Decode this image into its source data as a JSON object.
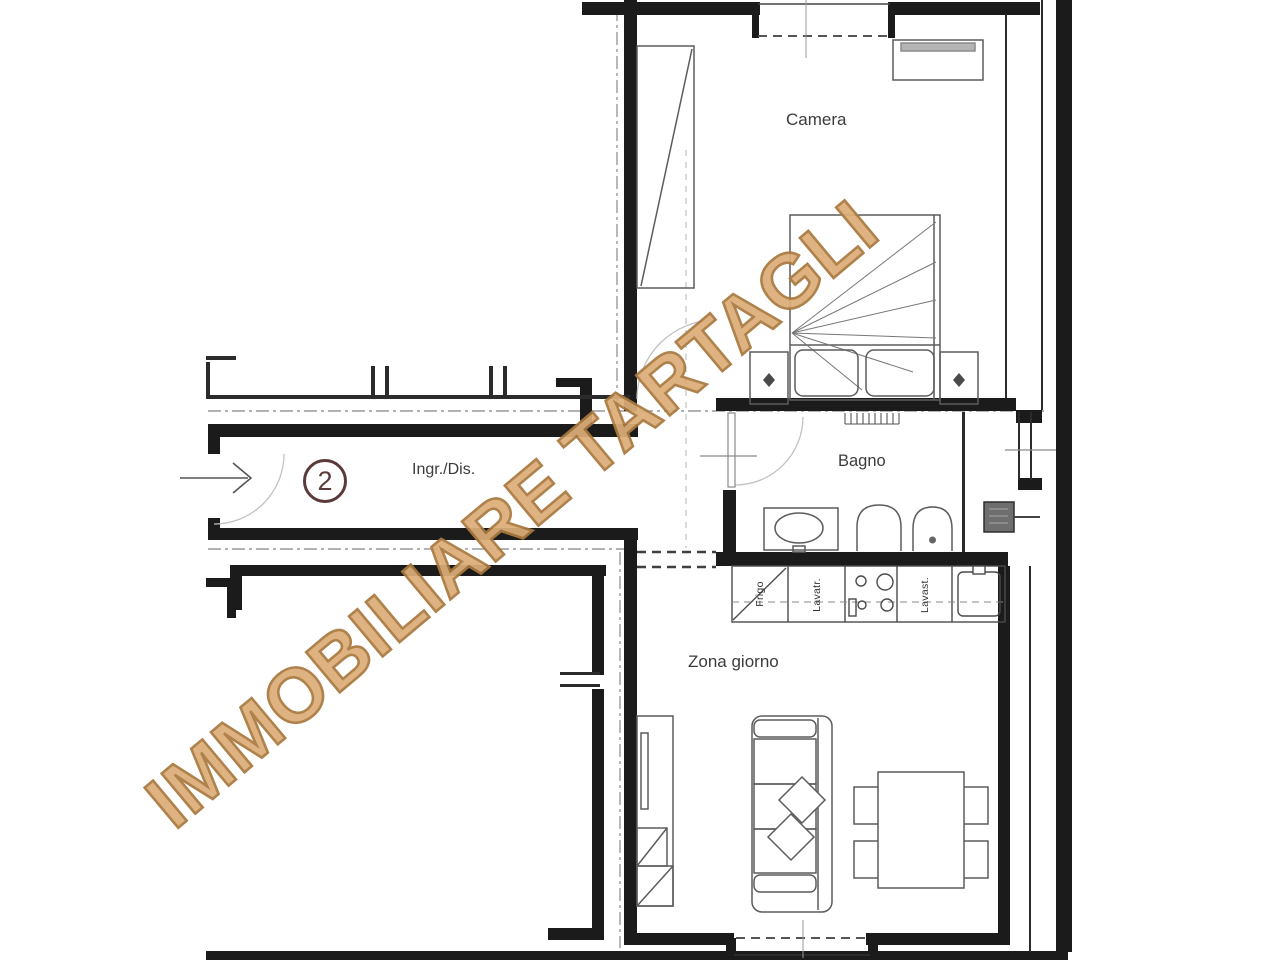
{
  "watermark": {
    "text": "IMMOBILIARE TARTAGLI",
    "color": "#d8a96b"
  },
  "unit": {
    "number": "2",
    "badge_color": "#5a3a3a"
  },
  "rooms": {
    "bedroom": {
      "label": "Camera"
    },
    "bathroom": {
      "label": "Bagno"
    },
    "hall": {
      "label": "Ingr./Dis."
    },
    "living": {
      "label": "Zona giorno"
    }
  },
  "kitchen": {
    "appliances": [
      {
        "label": "Frigo"
      },
      {
        "label": "Lavatr."
      },
      {
        "label": "Lavast."
      }
    ]
  },
  "colors": {
    "wall": "#1b1b1b",
    "furniture_line": "#5c5c5c",
    "boundary_line": "#9a9a9a"
  }
}
